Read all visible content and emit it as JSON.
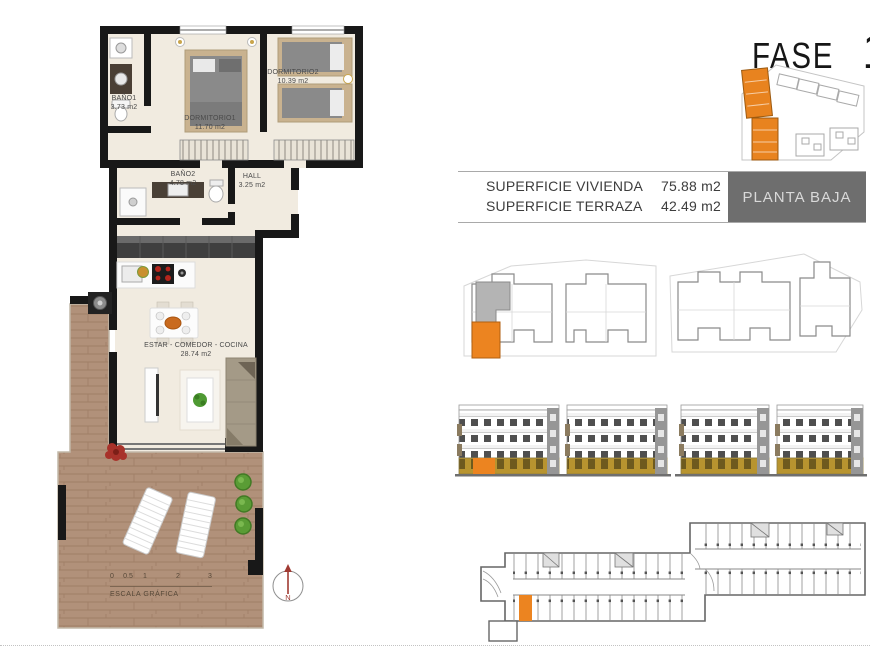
{
  "header": {
    "fase_label": "FASE",
    "phase_number": "1",
    "floor_label": "PLANTA BAJA"
  },
  "area_table": {
    "rows": [
      {
        "label": "SUPERFICIE VIVIENDA",
        "value": "75.88 m2"
      },
      {
        "label": "SUPERFICIE TERRAZA",
        "value": "42.49 m2"
      }
    ]
  },
  "floor_plan": {
    "rooms": [
      {
        "name": "BAÑO1",
        "area": "3.73 m2"
      },
      {
        "name": "DORMITORIO1",
        "area": "11.70 m2"
      },
      {
        "name": "DORMITORIO2",
        "area": "10.39 m2"
      },
      {
        "name": "BAÑO2",
        "area": "4.78 m2"
      },
      {
        "name": "HALL",
        "area": "3.25 m2"
      },
      {
        "name": "ESTAR - COMEDOR - COCINA",
        "area": "28.74 m2"
      }
    ],
    "scale_bar": {
      "label": "ESCALA GRÁFICA",
      "ticks": [
        "0",
        "0.5",
        "1",
        "2",
        "3"
      ]
    },
    "north_indicator": "N"
  },
  "colors": {
    "highlight_orange": "#ec8420",
    "badge_gray": "#6e6e6e",
    "wood_floor": "#b1927a",
    "wall_black": "#181818",
    "ground_floor_ochre": "#b8942f"
  }
}
